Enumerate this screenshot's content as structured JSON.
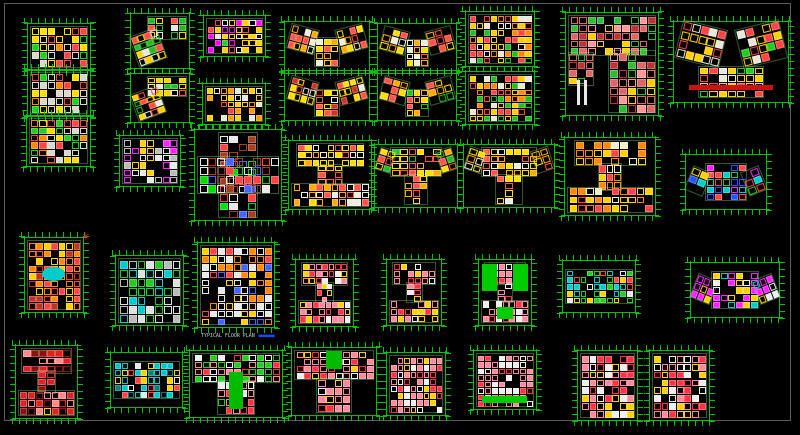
{
  "app": {
    "background": "#000000",
    "frame_color": "#5c5c5c",
    "dimension_color": "#00cc00",
    "description": "CAD model space with residential floor plan blocks"
  },
  "north_arrow": {
    "x": 82,
    "y": 230,
    "glyph": "✳",
    "color": "#ff2020"
  },
  "caption": {
    "text": "TYPICAL FLOOR PLAN",
    "underline_color": "#2244ee"
  },
  "plans": [
    {
      "id": "p01",
      "x": 30,
      "y": 26,
      "w": 58,
      "h": 42,
      "shape": "rect",
      "cell": 8,
      "palette": [
        "#d8d8cc",
        "#ff4444",
        "#ffdd00",
        "#22cc22",
        "#ff8800"
      ]
    },
    {
      "id": "p02",
      "x": 30,
      "y": 72,
      "w": 58,
      "h": 42,
      "shape": "rect",
      "cell": 8,
      "palette": [
        "#d8d8cc",
        "#ff4444",
        "#ffdd00",
        "#22cc22",
        "#ff8800"
      ]
    },
    {
      "id": "p03",
      "x": 29,
      "y": 118,
      "w": 59,
      "h": 46,
      "shape": "rect",
      "cell": 8,
      "palette": [
        "#d8d8cc",
        "#ff4444",
        "#ffdd00",
        "#22cc22",
        "#ff8800"
      ]
    },
    {
      "id": "p04",
      "x": 133,
      "y": 16,
      "w": 54,
      "h": 50,
      "shape": "L",
      "cell": 8,
      "palette": [
        "#ffd000",
        "#ff5040",
        "#e8e8e0",
        "#22bb22"
      ]
    },
    {
      "id": "p05",
      "x": 133,
      "y": 76,
      "w": 54,
      "h": 44,
      "shape": "L",
      "cell": 8,
      "palette": [
        "#ffd000",
        "#ff5040",
        "#e8e8e0",
        "#22bb22"
      ]
    },
    {
      "id": "p06",
      "x": 206,
      "y": 18,
      "w": 57,
      "h": 36,
      "shape": "rect",
      "cell": 7,
      "palette": [
        "#ffd000",
        "#ff4444",
        "#22cc22",
        "#e8e8e8",
        "#ff00ff"
      ]
    },
    {
      "id": "p07",
      "x": 205,
      "y": 86,
      "w": 58,
      "h": 36,
      "shape": "rect",
      "cell": 7,
      "palette": [
        "#ff9900",
        "#ffd000",
        "#ff4444",
        "#e8e8d8"
      ]
    },
    {
      "id": "p08",
      "x": 287,
      "y": 24,
      "w": 80,
      "h": 44,
      "shape": "wings",
      "cell": 8,
      "palette": [
        "#ffdd00",
        "#ffaa00",
        "#ff5544",
        "#eeeedd"
      ]
    },
    {
      "id": "p09",
      "x": 287,
      "y": 76,
      "w": 80,
      "h": 42,
      "shape": "wings",
      "cell": 8,
      "palette": [
        "#ffdd00",
        "#ff5544",
        "#cc3322",
        "#eeeedd"
      ]
    },
    {
      "id": "p10",
      "x": 380,
      "y": 26,
      "w": 74,
      "h": 42,
      "shape": "wings",
      "cell": 8,
      "palette": [
        "#ffdd00",
        "#ffaa00",
        "#ff5544",
        "#eeeedd"
      ]
    },
    {
      "id": "p11",
      "x": 380,
      "y": 76,
      "w": 74,
      "h": 42,
      "shape": "wings",
      "cell": 8,
      "palette": [
        "#ffdd00",
        "#ffaa00",
        "#ff5544",
        "#22bb22"
      ]
    },
    {
      "id": "p12",
      "x": 468,
      "y": 14,
      "w": 64,
      "h": 50,
      "shape": "rect",
      "cell": 7,
      "palette": [
        "#ffcc00",
        "#ff4444",
        "#ff8800",
        "#e8e8d8",
        "#22bb22"
      ]
    },
    {
      "id": "p13",
      "x": 468,
      "y": 74,
      "w": 64,
      "h": 48,
      "shape": "rect",
      "cell": 7,
      "palette": [
        "#ffcc00",
        "#ff4444",
        "#ff8800",
        "#e8e8d8",
        "#22bb22"
      ]
    },
    {
      "id": "p14",
      "x": 568,
      "y": 15,
      "w": 88,
      "h": 98,
      "shape": "bigsq",
      "cell": 9,
      "palette": [
        "#dd6666",
        "#bb3333",
        "#ff9999",
        "#33bb33",
        "#ffcc00"
      ],
      "features": [
        {
          "kind": "bars",
          "x": 0.1,
          "y": 0.66,
          "w": 0.16,
          "h": 0.26,
          "color": "#e8e8e8"
        }
      ]
    },
    {
      "id": "p15",
      "x": 676,
      "y": 24,
      "w": 110,
      "h": 76,
      "shape": "V",
      "cell": 9,
      "palette": [
        "#ffd000",
        "#ff4444",
        "#22cc22",
        "#e8e8d8"
      ],
      "features": [
        {
          "kind": "fill",
          "x": 0.12,
          "y": 0.8,
          "w": 0.76,
          "h": 0.07,
          "color": "#cc1111"
        }
      ]
    },
    {
      "id": "p16",
      "x": 122,
      "y": 138,
      "w": 56,
      "h": 46,
      "shape": "rect",
      "cell": 8,
      "palette": [
        "#e8e8e8",
        "#ff22ff",
        "#bbbbbb",
        "#ffd000"
      ]
    },
    {
      "id": "p17",
      "x": 197,
      "y": 132,
      "w": 82,
      "h": 86,
      "shape": "cross",
      "cell": 9,
      "palette": [
        "#a04020",
        "#ff4444",
        "#00dd00",
        "#4466ff",
        "#e8e8e8"
      ]
    },
    {
      "id": "p18",
      "x": 291,
      "y": 143,
      "w": 78,
      "h": 64,
      "shape": "H",
      "cell": 8,
      "palette": [
        "#ffdd00",
        "#ffaa00",
        "#ff5544",
        "#eeeedd"
      ]
    },
    {
      "id": "p19",
      "x": 377,
      "y": 147,
      "w": 78,
      "h": 58,
      "shape": "Twing",
      "cell": 8,
      "palette": [
        "#ffdd00",
        "#ffaa00",
        "#ff5544",
        "#22bb22"
      ]
    },
    {
      "id": "p20",
      "x": 466,
      "y": 147,
      "w": 86,
      "h": 58,
      "shape": "Twing",
      "cell": 8,
      "palette": [
        "#ffdd00",
        "#ffaa00",
        "#ff5544",
        "#eeeedd"
      ]
    },
    {
      "id": "p21",
      "x": 567,
      "y": 140,
      "w": 86,
      "h": 73,
      "shape": "I",
      "cell": 9,
      "palette": [
        "#ff8800",
        "#ffd000",
        "#ff4444",
        "#eeeecc"
      ]
    },
    {
      "id": "p22",
      "x": 688,
      "y": 157,
      "w": 76,
      "h": 50,
      "shape": "hex",
      "cell": 8,
      "palette": [
        "#ff4444",
        "#00cccc",
        "#2255ff",
        "#22cc22",
        "#ffd000",
        "#ff22ff"
      ]
    },
    {
      "id": "p23",
      "x": 27,
      "y": 240,
      "w": 54,
      "h": 70,
      "shape": "rect",
      "cell": 8,
      "palette": [
        "#ff8800",
        "#ff4444",
        "#c03322",
        "#ffd000"
      ],
      "features": [
        {
          "kind": "ellipse",
          "x": 0.28,
          "y": 0.38,
          "w": 0.42,
          "h": 0.2,
          "color": "#00cccc"
        }
      ]
    },
    {
      "id": "p24",
      "x": 118,
      "y": 258,
      "w": 63,
      "h": 65,
      "shape": "rect",
      "cell": 9,
      "palette": [
        "#e0e0e0",
        "#22cc22",
        "#00cccc",
        "#bbbbbb"
      ]
    },
    {
      "id": "p25",
      "x": 200,
      "y": 245,
      "w": 72,
      "h": 80,
      "shape": "rect",
      "cell": 8,
      "palette": [
        "#e8e8e8",
        "#ff8800",
        "#ff4444",
        "#4466ff",
        "#ffd000"
      ],
      "label": "TYPICAL FLOOR PLAN"
    },
    {
      "id": "p26",
      "x": 298,
      "y": 262,
      "w": 53,
      "h": 62,
      "shape": "H",
      "cell": 7,
      "palette": [
        "#ff8899",
        "#ff3344",
        "#eeeeee",
        "#ffd000"
      ]
    },
    {
      "id": "p27",
      "x": 389,
      "y": 262,
      "w": 50,
      "h": 61,
      "shape": "H",
      "cell": 7,
      "palette": [
        "#ff8899",
        "#ff3344",
        "#eeeeee",
        "#ffd000"
      ]
    },
    {
      "id": "p28",
      "x": 481,
      "y": 262,
      "w": 48,
      "h": 61,
      "shape": "H",
      "cell": 7,
      "palette": [
        "#ff8899",
        "#ff3344",
        "#eeeeee"
      ],
      "features": [
        {
          "kind": "fill",
          "x": 0.03,
          "y": 0.04,
          "w": 0.3,
          "h": 0.44,
          "color": "#00cc00"
        },
        {
          "kind": "fill",
          "x": 0.67,
          "y": 0.04,
          "w": 0.3,
          "h": 0.44,
          "color": "#00cc00"
        },
        {
          "kind": "fill",
          "x": 0.34,
          "y": 0.74,
          "w": 0.32,
          "h": 0.2,
          "color": "#00cc00"
        }
      ]
    },
    {
      "id": "p29",
      "x": 565,
      "y": 263,
      "w": 68,
      "h": 47,
      "shape": "bar",
      "cell": 7,
      "palette": [
        "#00cccc",
        "#22cc22",
        "#ffd000",
        "#e8e8e8",
        "#ff4444"
      ]
    },
    {
      "id": "p30",
      "x": 693,
      "y": 265,
      "w": 84,
      "h": 50,
      "shape": "hex",
      "cell": 8,
      "palette": [
        "#ff22ff",
        "#ffd000",
        "#00cccc",
        "#eeeeee"
      ]
    },
    {
      "id": "p31",
      "x": 18,
      "y": 348,
      "w": 57,
      "h": 68,
      "shape": "H",
      "cell": 8,
      "palette": [
        "#dd2222",
        "#8a1111",
        "#ff8888",
        "#ffcc00"
      ]
    },
    {
      "id": "p32",
      "x": 113,
      "y": 355,
      "w": 67,
      "h": 50,
      "shape": "bar",
      "cell": 7,
      "palette": [
        "#00c8c8",
        "#008080",
        "#ffd000",
        "#ff4444",
        "#e8e8e8"
      ]
    },
    {
      "id": "p33",
      "x": 192,
      "y": 353,
      "w": 88,
      "h": 62,
      "shape": "T",
      "cell": 8,
      "palette": [
        "#ff8899",
        "#ff3344",
        "#eeeeee",
        "#22cc22"
      ],
      "features": [
        {
          "kind": "fill",
          "x": 0.42,
          "y": 0.3,
          "w": 0.16,
          "h": 0.6,
          "color": "#00bb00"
        }
      ]
    },
    {
      "id": "p34",
      "x": 294,
      "y": 350,
      "w": 80,
      "h": 63,
      "shape": "T",
      "cell": 8,
      "palette": [
        "#ff8899",
        "#ff3344",
        "#eeeeee",
        "#ffd000"
      ],
      "features": [
        {
          "kind": "fill",
          "x": 0.4,
          "y": 0.02,
          "w": 0.2,
          "h": 0.28,
          "color": "#00bb00"
        }
      ]
    },
    {
      "id": "p35",
      "x": 389,
      "y": 355,
      "w": 54,
      "h": 58,
      "shape": "rect",
      "cell": 7,
      "palette": [
        "#ff8899",
        "#ff3344",
        "#eeeeee",
        "#ffd000"
      ]
    },
    {
      "id": "p36",
      "x": 476,
      "y": 353,
      "w": 58,
      "h": 54,
      "shape": "rect",
      "cell": 7,
      "palette": [
        "#ff8899",
        "#ff3344",
        "#eeeeee"
      ],
      "features": [
        {
          "kind": "fill",
          "x": 0.1,
          "y": 0.8,
          "w": 0.78,
          "h": 0.13,
          "color": "#00cc00"
        }
      ]
    },
    {
      "id": "p37",
      "x": 580,
      "y": 353,
      "w": 55,
      "h": 65,
      "shape": "rect",
      "cell": 8,
      "palette": [
        "#ff8899",
        "#ff3344",
        "#eeeeee",
        "#ffd000"
      ]
    },
    {
      "id": "p38",
      "x": 652,
      "y": 353,
      "w": 55,
      "h": 65,
      "shape": "rect",
      "cell": 8,
      "palette": [
        "#ff8899",
        "#ff3344",
        "#eeeeee",
        "#ffd000"
      ]
    }
  ]
}
